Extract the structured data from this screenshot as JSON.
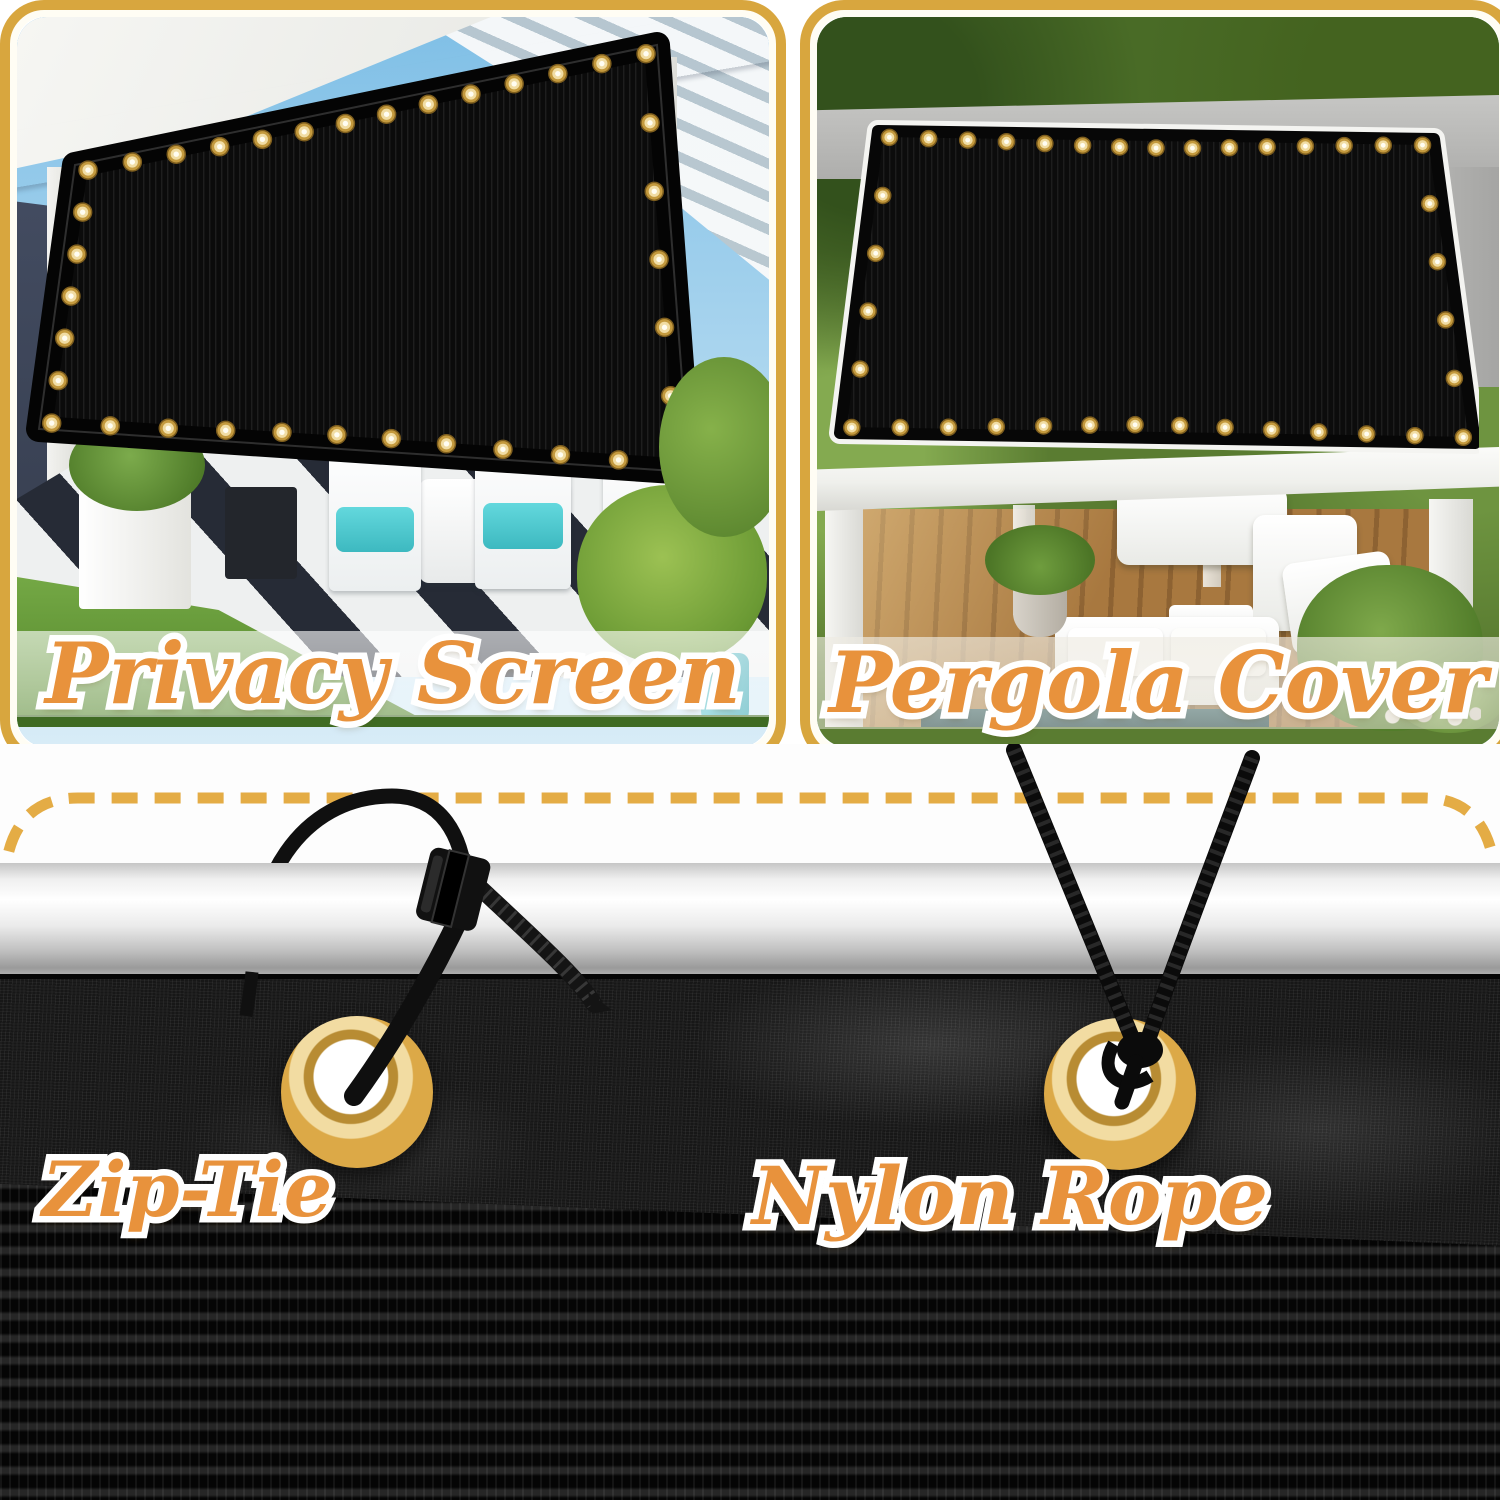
{
  "panels": [
    {
      "id": "privacy-screen",
      "label": "Privacy Screen"
    },
    {
      "id": "pergola-cover",
      "label": "Pergola Cover"
    }
  ],
  "installation_methods": [
    {
      "id": "zip-tie",
      "label": "Zip-Tie"
    },
    {
      "id": "nylon-rope",
      "label": "Nylon Rope"
    }
  ],
  "colors": {
    "panel_border_gold": "#D8A63E",
    "inner_border_cream": "#FFFDF4",
    "dashed_line_gold": "#E4AC45",
    "label_orange": "#E8923C",
    "label_outline": "#FFFFFF",
    "grommet_gold": "#DCA947",
    "fabric_black": "#141414",
    "pole_silver": "#DADADA",
    "cushion_teal": "#4FC9CF"
  }
}
